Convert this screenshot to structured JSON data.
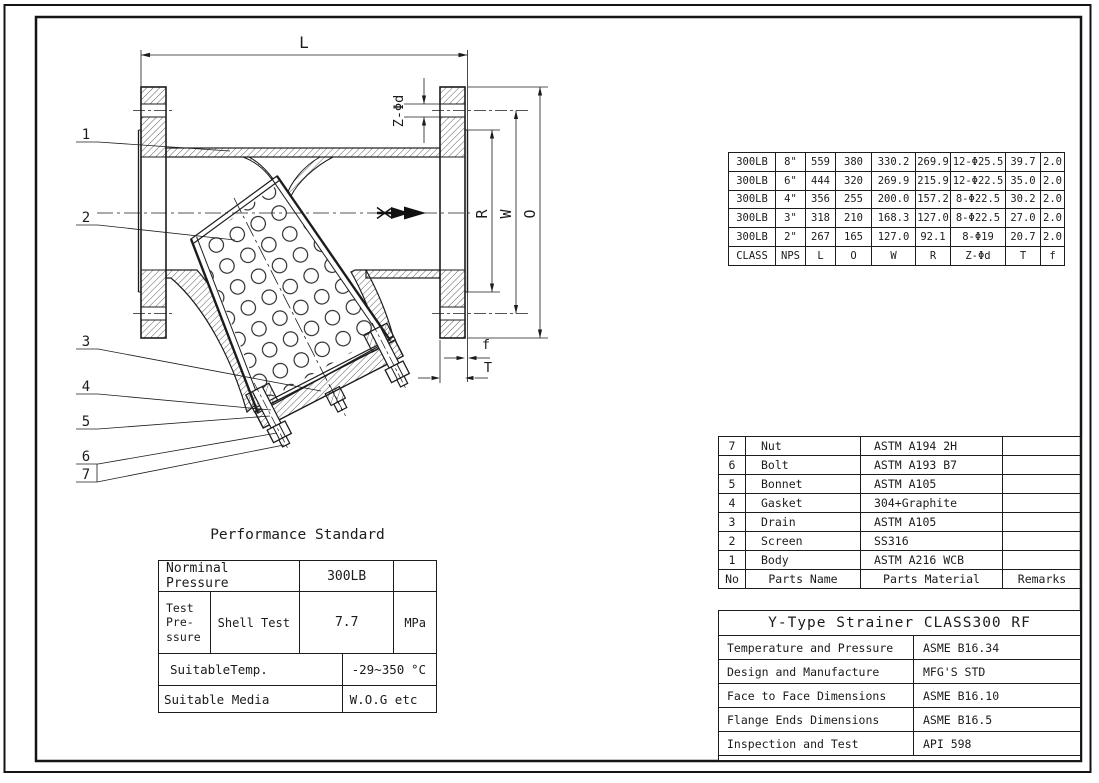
{
  "drawing": {
    "dim_labels": {
      "L": "L",
      "O": "O",
      "W": "W",
      "R": "R",
      "Z_phi_d": "Z-Φd",
      "T": "T",
      "f": "f"
    },
    "part_numbers": [
      "1",
      "2",
      "3",
      "4",
      "5",
      "6",
      "7"
    ]
  },
  "dimension_table": {
    "header": [
      "CLASS",
      "NPS",
      "L",
      "O",
      "W",
      "R",
      "Z-Φd",
      "T",
      "f"
    ],
    "rows": [
      [
        "300LB",
        "8\"",
        "559",
        "380",
        "330.2",
        "269.9",
        "12-Φ25.5",
        "39.7",
        "2.0"
      ],
      [
        "300LB",
        "6\"",
        "444",
        "320",
        "269.9",
        "215.9",
        "12-Φ22.5",
        "35.0",
        "2.0"
      ],
      [
        "300LB",
        "4\"",
        "356",
        "255",
        "200.0",
        "157.2",
        "8-Φ22.5",
        "30.2",
        "2.0"
      ],
      [
        "300LB",
        "3\"",
        "318",
        "210",
        "168.3",
        "127.0",
        "8-Φ22.5",
        "27.0",
        "2.0"
      ],
      [
        "300LB",
        "2\"",
        "267",
        "165",
        "127.0",
        "92.1",
        "8-Φ19",
        "20.7",
        "2.0"
      ]
    ]
  },
  "parts_table": {
    "header": [
      "No",
      "Parts Name",
      "Parts Material",
      "Remarks"
    ],
    "rows": [
      [
        "7",
        "Nut",
        "ASTM A194 2H",
        ""
      ],
      [
        "6",
        "Bolt",
        "ASTM A193 B7",
        ""
      ],
      [
        "5",
        "Bonnet",
        "ASTM A105",
        ""
      ],
      [
        "4",
        "Gasket",
        "304+Graphite",
        ""
      ],
      [
        "3",
        "Drain",
        "ASTM A105",
        ""
      ],
      [
        "2",
        "Screen",
        "SS316",
        ""
      ],
      [
        "1",
        "Body",
        "ASTM A216 WCB",
        ""
      ]
    ]
  },
  "title_block": {
    "title": "Y-Type Strainer  CLASS300  RF",
    "rows": [
      [
        "Temperature and Pressure",
        "ASME B16.34"
      ],
      [
        "Design and Manufacture",
        "MFG'S STD"
      ],
      [
        "Face to Face Dimensions",
        "ASME B16.10"
      ],
      [
        "Flange Ends Dimensions",
        "ASME B16.5"
      ],
      [
        "Inspection and Test",
        "API 598"
      ]
    ]
  },
  "performance": {
    "title": "Performance Standard",
    "nominal_pressure_label": "Norminal Pressure",
    "nominal_pressure_value": "300LB",
    "test_pressure_label": "Test\nPre-\nssure",
    "shell_test_label": "Shell Test",
    "shell_test_value": "7.7",
    "shell_test_unit": "MPa",
    "suitable_temp_label": "SuitableTemp.",
    "suitable_temp_value": "-29~350",
    "suitable_temp_unit": "°C",
    "suitable_media_label": "Suitable Media",
    "suitable_media_value": "W.O.G etc"
  }
}
